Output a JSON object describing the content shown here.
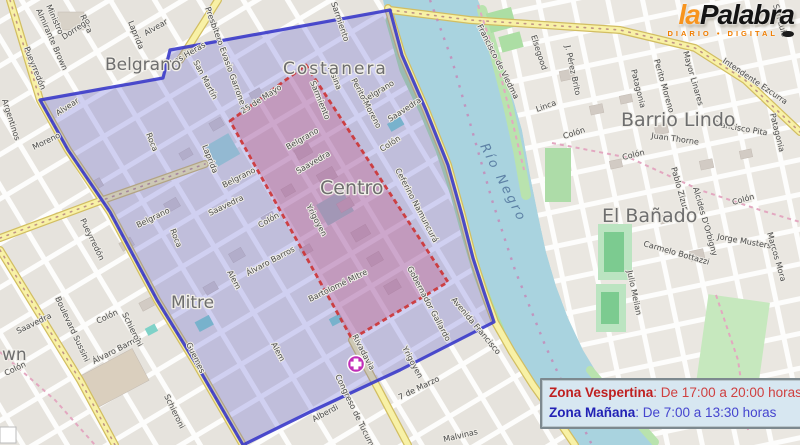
{
  "logo": {
    "part1": "la",
    "part2": "Palabra",
    "tagline": "DIARIO • DIGITAL"
  },
  "legend": {
    "rows": [
      {
        "name": "Zona Vespertina",
        "detail": ": De 17:00 a 20:00 horas",
        "color": "#bf2020"
      },
      {
        "name": "Zona Mañana",
        "detail": ": De 7:00 a 13:30 horas",
        "color": "#2222b5"
      }
    ]
  },
  "map": {
    "zone_colors": {
      "manana_border": "#3636C8",
      "manana_fill": "#6A6AD8",
      "vespertina_border": "#CC3333",
      "vespertina_fill": "#C84A78"
    },
    "water_label": {
      "text": "Río Negro",
      "x": 480,
      "y": 146,
      "r": 63,
      "s": 13,
      "ls": 2.5
    },
    "districts": [
      {
        "label": "Belgrano",
        "x": 105,
        "y": 70,
        "s": 17
      },
      {
        "label": "Costanera",
        "x": 283,
        "y": 74,
        "s": 17,
        "ls": 2
      },
      {
        "label": "Centro",
        "x": 320,
        "y": 194,
        "s": 19
      },
      {
        "label": "Mitre",
        "x": 171,
        "y": 308,
        "s": 17
      },
      {
        "label": "Barrio Lindo",
        "x": 621,
        "y": 126,
        "s": 19
      },
      {
        "label": "El Bañado",
        "x": 602,
        "y": 222,
        "s": 19
      },
      {
        "label": "wn",
        "x": 2,
        "y": 360,
        "s": 17
      }
    ],
    "streets": [
      {
        "n": "Pueyrredón",
        "x": 24,
        "y": 48,
        "r": 68
      },
      {
        "n": "Pueyrredón",
        "x": 80,
        "y": 220,
        "r": 64,
        "s": 8.5
      },
      {
        "n": "Ministro",
        "x": 46,
        "y": 6,
        "r": 66
      },
      {
        "n": "Almirante Brown",
        "x": 36,
        "y": 10,
        "r": 66
      },
      {
        "n": "Roca",
        "x": 80,
        "y": 16,
        "r": 66
      },
      {
        "n": "Dorrego",
        "x": 64,
        "y": 40,
        "r": -34
      },
      {
        "n": "Alvear",
        "x": 58,
        "y": 116,
        "r": -33
      },
      {
        "n": "Alvear",
        "x": 146,
        "y": 36,
        "r": -30
      },
      {
        "n": "Argentinos",
        "x": 2,
        "y": 100,
        "r": 72
      },
      {
        "n": "Laprida",
        "x": 128,
        "y": 22,
        "r": 68
      },
      {
        "n": "Laprida",
        "x": 202,
        "y": 146,
        "r": 68
      },
      {
        "n": "Moreno",
        "x": 34,
        "y": 150,
        "r": -26
      },
      {
        "n": "Las Heras",
        "x": 172,
        "y": 66,
        "r": -30
      },
      {
        "n": "San Martín",
        "x": 193,
        "y": 62,
        "r": 62,
        "s": 9.5
      },
      {
        "n": "Presbítero Evasio Garrone",
        "x": 205,
        "y": 8,
        "r": 70
      },
      {
        "n": "Sarmiento",
        "x": 331,
        "y": 3,
        "r": 71
      },
      {
        "n": "Alsina",
        "x": 328,
        "y": 68,
        "r": 68
      },
      {
        "n": "25 de Mayo",
        "x": 243,
        "y": 114,
        "r": -33,
        "s": 10.5
      },
      {
        "n": "Sarmiento",
        "x": 310,
        "y": 82,
        "r": 68
      },
      {
        "n": "Belgrano",
        "x": 138,
        "y": 228,
        "r": -26
      },
      {
        "n": "Belgrano",
        "x": 224,
        "y": 188,
        "r": -27
      },
      {
        "n": "Belgrano",
        "x": 288,
        "y": 150,
        "r": -30
      },
      {
        "n": "Belgrano",
        "x": 364,
        "y": 103,
        "r": -31
      },
      {
        "n": "Roca",
        "x": 146,
        "y": 134,
        "r": 68
      },
      {
        "n": "Roca",
        "x": 170,
        "y": 230,
        "r": 68
      },
      {
        "n": "Saavedra",
        "x": 18,
        "y": 334,
        "r": -26
      },
      {
        "n": "Saavedra",
        "x": 210,
        "y": 216,
        "r": -26
      },
      {
        "n": "Saavedra",
        "x": 298,
        "y": 174,
        "r": -30
      },
      {
        "n": "Saavedra",
        "x": 390,
        "y": 122,
        "r": -33
      },
      {
        "n": "Colón",
        "x": 6,
        "y": 376,
        "r": -26
      },
      {
        "n": "Colón",
        "x": 98,
        "y": 324,
        "r": -26
      },
      {
        "n": "Colón",
        "x": 260,
        "y": 228,
        "r": -30
      },
      {
        "n": "Colón",
        "x": 382,
        "y": 152,
        "r": -33
      },
      {
        "n": "Alem",
        "x": 227,
        "y": 272,
        "r": 62
      },
      {
        "n": "Alem",
        "x": 271,
        "y": 344,
        "r": 62
      },
      {
        "n": "Álvaro Barros",
        "x": 94,
        "y": 364,
        "r": -27
      },
      {
        "n": "Álvaro Barros",
        "x": 248,
        "y": 276,
        "r": -28
      },
      {
        "n": "Bartolomé Mitre",
        "x": 310,
        "y": 302,
        "r": -26
      },
      {
        "n": "Yrigoyen",
        "x": 306,
        "y": 206,
        "r": 62
      },
      {
        "n": "Yrigoyen",
        "x": 402,
        "y": 348,
        "r": 62
      },
      {
        "n": "Rivadavia",
        "x": 352,
        "y": 336,
        "r": 62,
        "s": 10
      },
      {
        "n": "Congreso de Tucumán",
        "x": 335,
        "y": 376,
        "r": 64
      },
      {
        "n": "Alberdi",
        "x": 314,
        "y": 422,
        "r": -28,
        "s": 8.5
      },
      {
        "n": "Guemes",
        "x": 186,
        "y": 344,
        "r": 64
      },
      {
        "n": "Schieroni",
        "x": 122,
        "y": 314,
        "r": 64
      },
      {
        "n": "Schieroni",
        "x": 164,
        "y": 396,
        "r": 64
      },
      {
        "n": "Boulevard Sussini",
        "x": 55,
        "y": 298,
        "r": 65,
        "s": 10
      },
      {
        "n": "7 de Marzo",
        "x": 400,
        "y": 400,
        "r": -26
      },
      {
        "n": "Malvinas",
        "x": 444,
        "y": 442,
        "r": -13
      },
      {
        "n": "Avenida Francisco",
        "x": 451,
        "y": 300,
        "r": 50,
        "s": 10.5
      },
      {
        "n": "Francisco de Viedma",
        "x": 477,
        "y": 26,
        "r": 63
      },
      {
        "n": "San Luis",
        "x": 773,
        "y": 5,
        "r": 74
      },
      {
        "n": "Ceferino Namuncurá",
        "x": 395,
        "y": 170,
        "r": 62
      },
      {
        "n": "Gobernador Gallardo",
        "x": 407,
        "y": 268,
        "r": 62
      },
      {
        "n": "Perito Moreno",
        "x": 351,
        "y": 80,
        "r": 62
      },
      {
        "n": "Elsegood",
        "x": 531,
        "y": 36,
        "r": 72
      },
      {
        "n": "J. Pérez Brito",
        "x": 565,
        "y": 46,
        "r": 78
      },
      {
        "n": "Linca",
        "x": 537,
        "y": 112,
        "r": -20
      },
      {
        "n": "Colón",
        "x": 564,
        "y": 139,
        "r": -18
      },
      {
        "n": "Patagonia",
        "x": 631,
        "y": 70,
        "r": 76
      },
      {
        "n": "Patagonia",
        "x": 770,
        "y": 114,
        "r": 76
      },
      {
        "n": "Perito Moreno",
        "x": 654,
        "y": 60,
        "r": 74
      },
      {
        "n": "Mayor Linares",
        "x": 683,
        "y": 52,
        "r": 74
      },
      {
        "n": "Intendente Ezcurra",
        "x": 722,
        "y": 62,
        "r": 34,
        "s": 11
      },
      {
        "n": "Francisco Pita",
        "x": 713,
        "y": 126,
        "r": 10
      },
      {
        "n": "Juan Thorne",
        "x": 651,
        "y": 138,
        "r": 8
      },
      {
        "n": "Colón",
        "x": 623,
        "y": 160,
        "r": -14
      },
      {
        "n": "Colón",
        "x": 733,
        "y": 205,
        "r": -16
      },
      {
        "n": "Pablo Zizur",
        "x": 671,
        "y": 168,
        "r": 74
      },
      {
        "n": "Alcides D'Orbigny",
        "x": 693,
        "y": 188,
        "r": 74
      },
      {
        "n": "Jorge Musters",
        "x": 717,
        "y": 239,
        "r": 10
      },
      {
        "n": "Carmelo Bottazzi",
        "x": 643,
        "y": 246,
        "r": 16
      },
      {
        "n": "Julio Meilan",
        "x": 627,
        "y": 271,
        "r": 78
      },
      {
        "n": "Marcos Mora",
        "x": 767,
        "y": 233,
        "r": 74
      }
    ]
  }
}
